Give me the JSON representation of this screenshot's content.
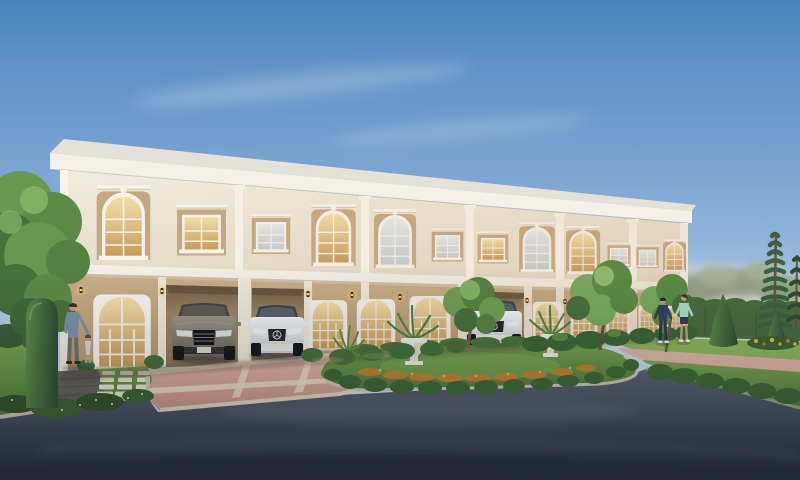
{
  "scene": {
    "type": "3d-architectural-exterior-render",
    "description": "Street-level dusk rendering of a long two-storey neoclassical townhouse row with arched windows, warm-lit French doors, carports with parked sedans, manicured garden islands and an asphalt access road curving through the foreground.",
    "time_of_day": "late afternoon dusk",
    "weather": "clear sky with thin wispy clouds",
    "building": {
      "storeys": 2,
      "units_visible": 6,
      "style": "neoclassical townhome row",
      "upper_arched_windows": 6,
      "upper_rectangular_windows": 6,
      "arched_french_doors": 5,
      "carports": 3,
      "wall_lanterns": 10
    },
    "vehicles": [
      {
        "label": "grey sedan parked front-facing in carport"
      },
      {
        "label": "white sedan parked in adjacent carport"
      },
      {
        "label": "white sedan parked in carport further right"
      }
    ],
    "people": [
      {
        "label": "man with toddler on front walkway"
      },
      {
        "label": "woman in navy tracksuit walking on lawn"
      },
      {
        "label": "woman in mint top and shorts walking on lawn"
      }
    ],
    "landscape": [
      "large leafy tree at left",
      "column topiary",
      "stepping-stone lawn path",
      "central garden island with hedge ring, orange flower band, two white urn planters and young tree",
      "cone topiaries at right",
      "hedge wall and distant treeline",
      "two tall slender conifers",
      "flower bed with yellow-orange blooms"
    ],
    "colors": {
      "sky_top": "#4a84c0",
      "sky_mid": "#8fb3d9",
      "sky_low": "#cfdde8",
      "horizon": "#eee4d2",
      "cloud": "#ffffff",
      "haze_warm": "#f6e8cc",
      "roof_top": "#e5e1d6",
      "fascia": "#f4f0e7",
      "fascia_shadow": "#cbc4b4",
      "wall_upper": "#f2ecdf",
      "wall_upper_deep": "#e3dac7",
      "pilaster": "#f7f4ec",
      "divider": "#f5f1e8",
      "window_panel": "#c4a981",
      "window_frame": "#f6f4ee",
      "trim_shadow": "#cfc8b8",
      "glass_cool": "#e7eaea",
      "glass_cool_deep": "#c3cacc",
      "glass_warm": "#f4e0ab",
      "glass_warm_deep": "#c59a57",
      "wall_ground": "#c9b089",
      "wall_ground_deep": "#b1966e",
      "carport_wall": "#9b8465",
      "carport_deep": "#6f5c46",
      "floor_cream": "#d9cab0",
      "lamp_glow": "#f6c46a",
      "driveway": "#e2b8aa",
      "driveway_deep": "#c69488",
      "paver_cream": "#ead9c1",
      "path_pink": "#dcb3a5",
      "walkway": "#63615d",
      "stone": "#e8e2d2",
      "curb": "#ccc6b4",
      "road": "#5c6572",
      "road_deep": "#2b323f",
      "grass": "#79a450",
      "grass_deep": "#4f7c38",
      "grass_bright": "#8cb35c",
      "hedge": "#3e6734",
      "hedge_light": "#5d8a46",
      "hedge_wall": "#4a6b40",
      "canopy": "#6a974f",
      "canopy_deep": "#47703a",
      "canopy_light": "#82b061",
      "treeline": "#8e9c80",
      "pine": "#3c6040",
      "trunk": "#6b5138",
      "flower_orange": "#c9812f",
      "flower_yellow": "#ddb64a",
      "flower_white": "#e3e9d4",
      "urn": "#efeade",
      "car_grey": "#9c968a",
      "car_grey_deep": "#6b655a",
      "car_white": "#f3f4f6",
      "car_white_deep": "#c6c9cd",
      "car_glass": "#4a5055",
      "tire": "#17181a",
      "skin": "#c79a78",
      "shirt_blue": "#7d8fa6",
      "pants_grey": "#70716f",
      "hair_dark": "#3a2f28",
      "outfit_navy": "#33405c",
      "outfit_mint": "#a8dac9"
    }
  }
}
